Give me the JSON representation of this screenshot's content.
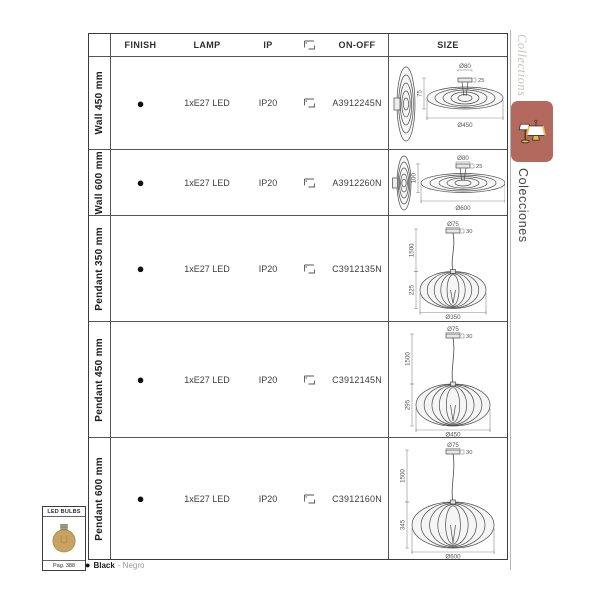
{
  "table": {
    "headers": {
      "finish": "FINISH",
      "lamp": "LAMP",
      "ip": "IP",
      "mount_icon": "mount-icon",
      "onoff": "ON-OFF",
      "size": "SIZE"
    },
    "rows": [
      {
        "label": "Wall 450 mm",
        "finish_dot": "●",
        "lamp": "1xE27 LED",
        "ip": "IP20",
        "code": "A3912245N",
        "diagram": {
          "type": "wall",
          "d_top": "Ø80",
          "d_side": "25",
          "d_height": "75",
          "d_width": "Ø450"
        }
      },
      {
        "label": "Wall 600 mm",
        "finish_dot": "●",
        "lamp": "1xE27 LED",
        "ip": "IP20",
        "code": "A3912260N",
        "diagram": {
          "type": "wall",
          "d_top": "Ø80",
          "d_side": "25",
          "d_height": "100",
          "d_width": "Ø600"
        }
      },
      {
        "label": "Pendant 350 mm",
        "finish_dot": "●",
        "lamp": "1xE27 LED",
        "ip": "IP20",
        "code": "C3912135N",
        "diagram": {
          "type": "pendant",
          "d_top": "Ø75",
          "d_side": "30",
          "d_cable": "1500",
          "d_height": "225",
          "d_width": "Ø350"
        }
      },
      {
        "label": "Pendant 450 mm",
        "finish_dot": "●",
        "lamp": "1xE27 LED",
        "ip": "IP20",
        "code": "C3912145N",
        "diagram": {
          "type": "pendant",
          "d_top": "Ø75",
          "d_side": "30",
          "d_cable": "1500",
          "d_height": "295",
          "d_width": "Ø450"
        }
      },
      {
        "label": "Pendant 600 mm",
        "finish_dot": "●",
        "lamp": "1xE27 LED",
        "ip": "IP20",
        "code": "C3912160N",
        "diagram": {
          "type": "pendant",
          "d_top": "Ø75",
          "d_side": "30",
          "d_cable": "1500",
          "d_height": "345",
          "d_width": "Ø600"
        }
      }
    ]
  },
  "sidebar": {
    "collections_en": "Collections",
    "collections_es": "Colecciones",
    "tab_color": "#b4695e",
    "tab_icon": "table-and-floor-lamp-icon"
  },
  "led_bulbs": {
    "title": "LED BULBS",
    "page_ref": "Pag. 388",
    "bulb_color": "#c7a263"
  },
  "footnote": {
    "dot": "●",
    "black": "Black",
    "negro": "- Negro"
  }
}
